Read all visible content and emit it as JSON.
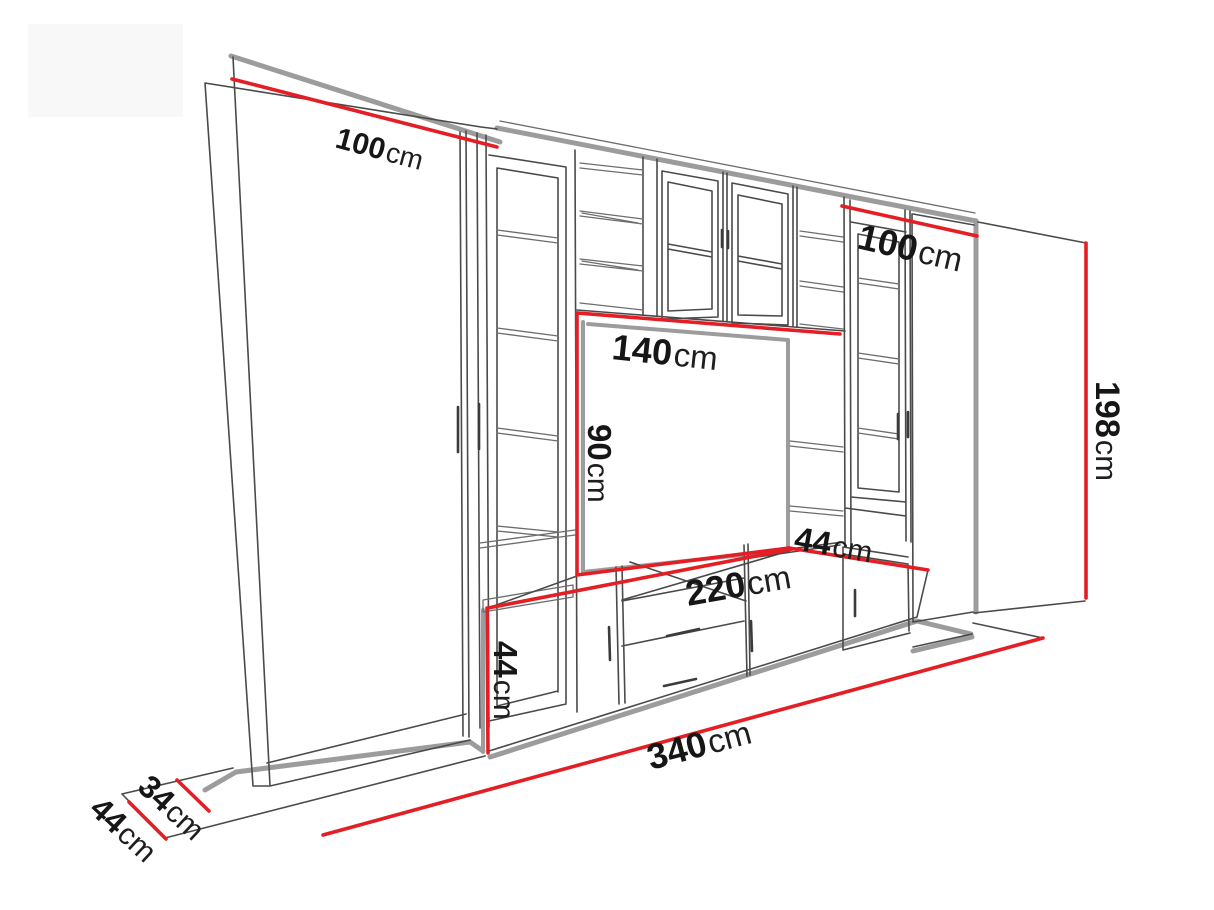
{
  "diagram": {
    "title": "wall-unit-dimension-diagram",
    "colors": {
      "dimension_red": "#e31e24",
      "shadow_gray": "#9c9c9c",
      "outline_gray": "#4a4a4a",
      "text_black": "#161616",
      "background": "#ffffff"
    },
    "dimensions": {
      "left_wardrobe_width": {
        "value": "100",
        "unit": "cm"
      },
      "right_wardrobe_width": {
        "value": "100",
        "unit": "cm"
      },
      "tv_niche_width": {
        "value": "140",
        "unit": "cm"
      },
      "tv_niche_height": {
        "value": "90",
        "unit": "cm"
      },
      "shelf_depth": {
        "value": "44",
        "unit": "cm"
      },
      "tv_stand_width": {
        "value": "220",
        "unit": "cm"
      },
      "tv_stand_height": {
        "value": "44",
        "unit": "cm"
      },
      "total_width": {
        "value": "340",
        "unit": "cm"
      },
      "total_height": {
        "value": "198",
        "unit": "cm"
      },
      "upper_depth": {
        "value": "34",
        "unit": "cm"
      },
      "base_depth": {
        "value": "44",
        "unit": "cm"
      }
    }
  }
}
